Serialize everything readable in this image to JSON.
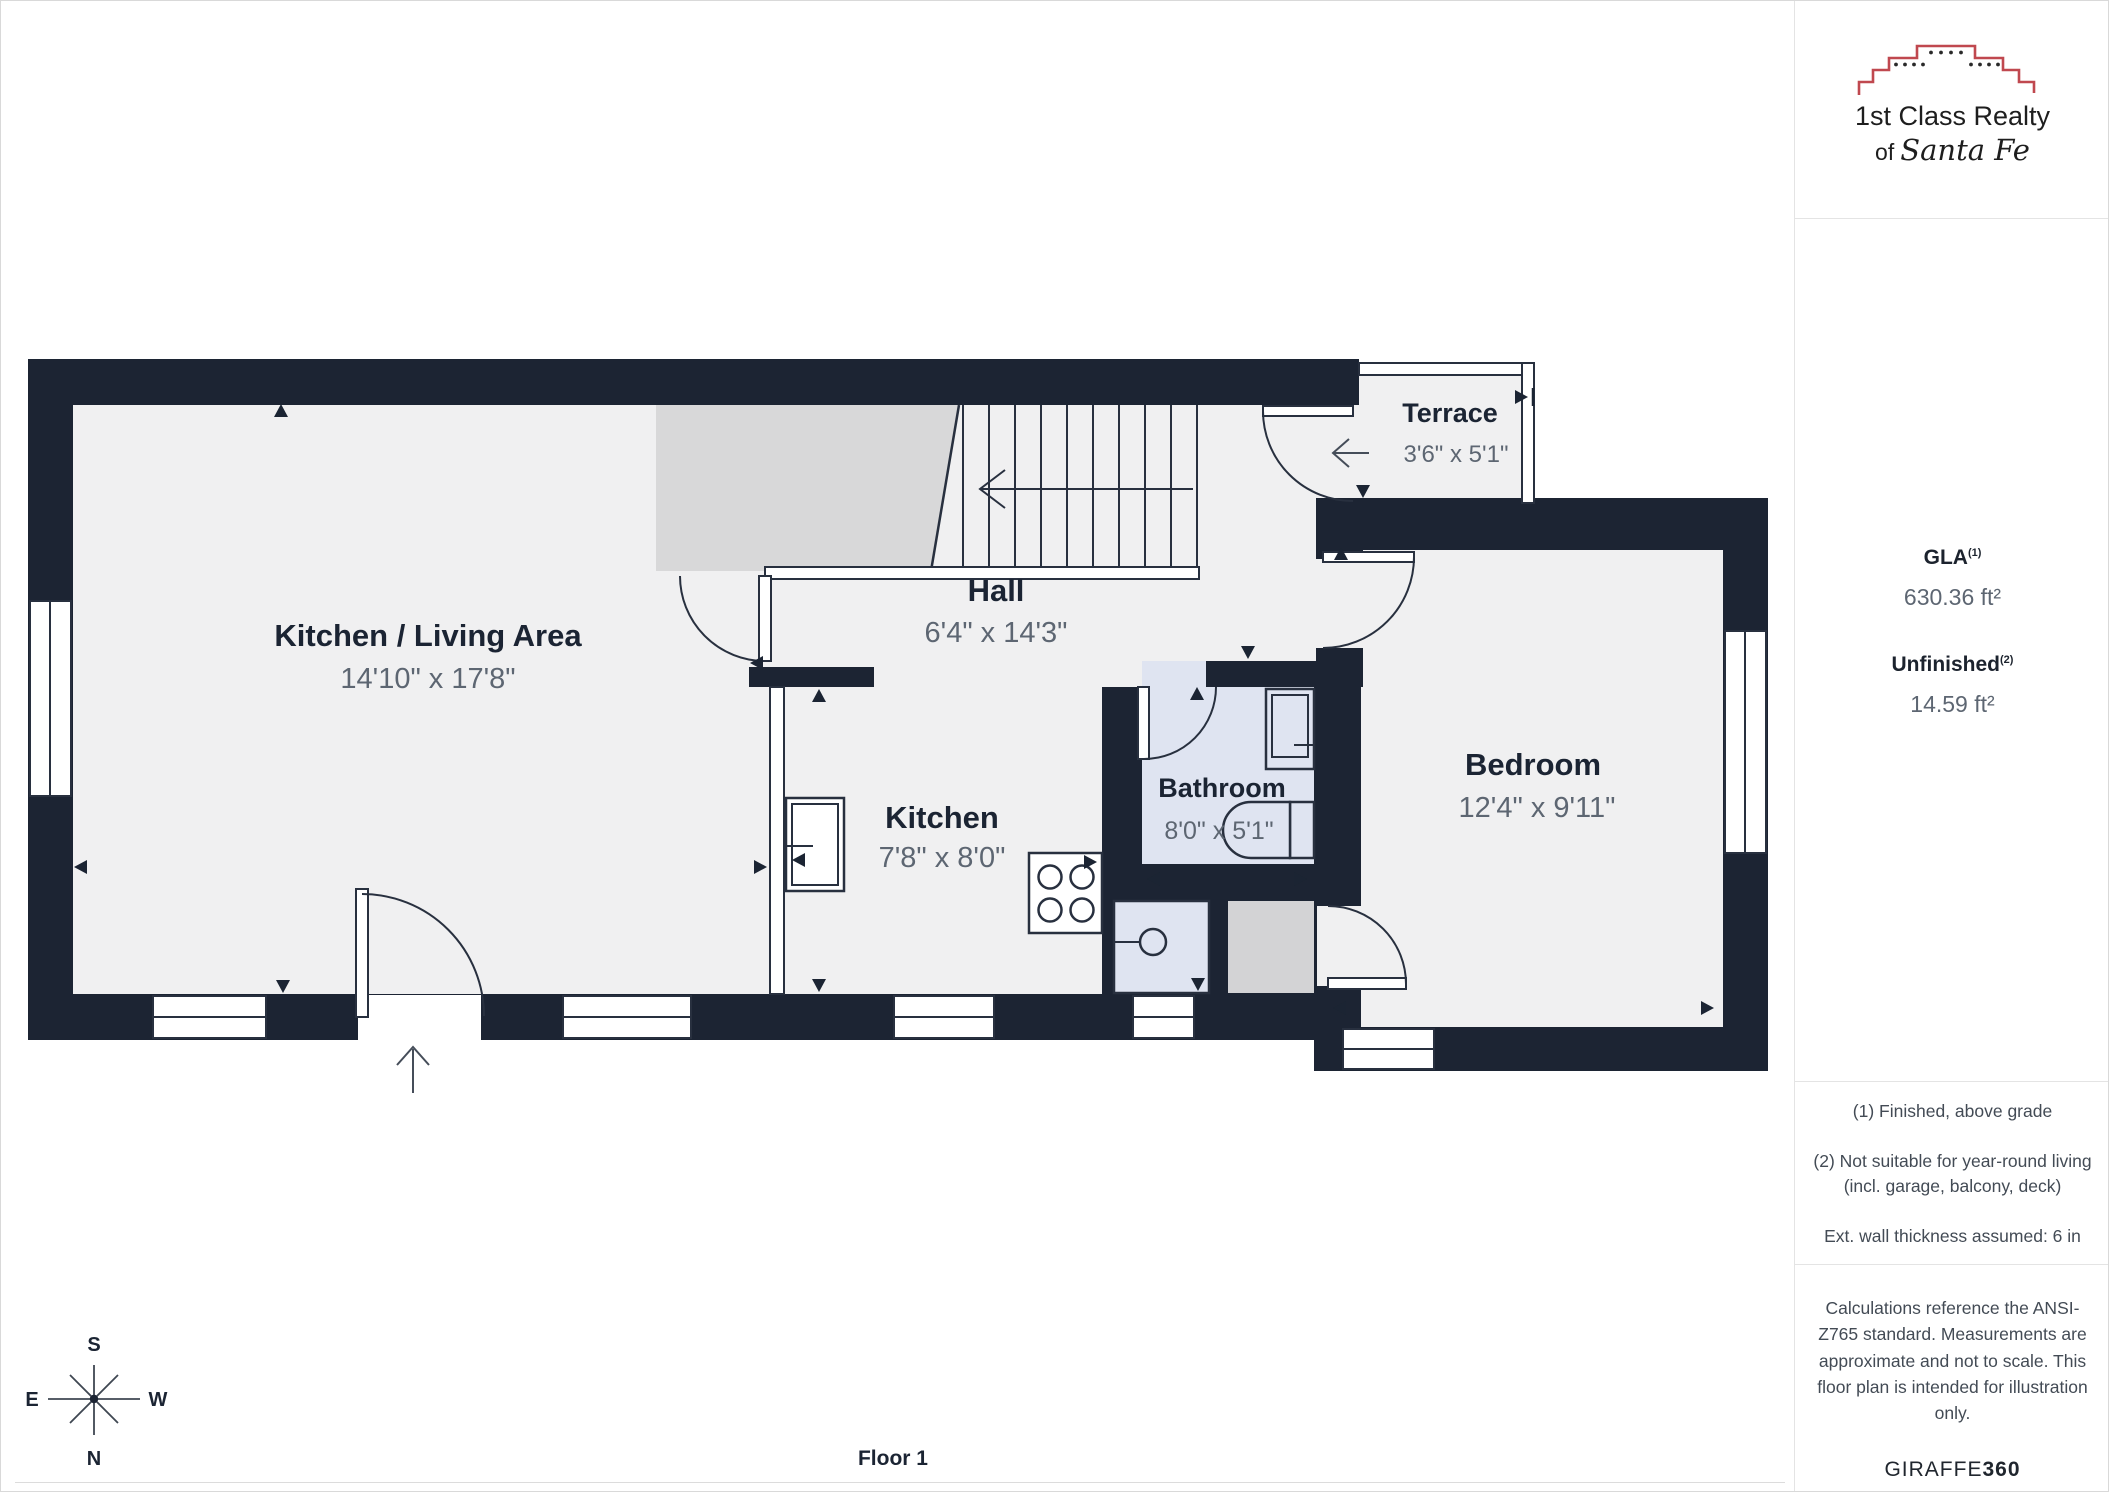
{
  "floor_plan": {
    "floor_label": "Floor 1",
    "rooms": [
      {
        "id": "kitchen-living",
        "name": "Kitchen / Living Area",
        "dims": "14'10\" x 17'8\""
      },
      {
        "id": "hall",
        "name": "Hall",
        "dims": "6'4\" x 14'3\""
      },
      {
        "id": "kitchen",
        "name": "Kitchen",
        "dims": "7'8\" x 8'0\""
      },
      {
        "id": "bathroom",
        "name": "Bathroom",
        "dims": "8'0\" x 5'1\""
      },
      {
        "id": "bedroom",
        "name": "Bedroom",
        "dims": "12'4\" x 9'11\""
      },
      {
        "id": "terrace",
        "name": "Terrace",
        "dims": "3'6\" x 5'1\""
      }
    ],
    "compass": {
      "n": "N",
      "s": "S",
      "e": "E",
      "w": "W"
    }
  },
  "sidebar": {
    "logo": {
      "line1": "1st Class Realty",
      "of": "of",
      "script": "Santa Fe"
    },
    "metrics": [
      {
        "label": "GLA",
        "sup": "(1)",
        "value": "630.36 ft²"
      },
      {
        "label": "Unfinished",
        "sup": "(2)",
        "value": "14.59 ft²"
      }
    ],
    "notes": [
      "(1) Finished, above grade",
      "(2) Not suitable for year-round living (incl. garage, balcony, deck)",
      "Ext. wall thickness assumed: 6 in"
    ],
    "disclaimer": "Calculations reference the ANSI-Z765 standard. Measurements are approximate and not to scale. This floor plan is intended for illustration only.",
    "brand": "GIRAFFE",
    "brand_suffix": "360"
  },
  "colors": {
    "wall": "#1c2433",
    "floor": "#f0f0f1",
    "bathroom_floor": "#dfe4f1",
    "stairs_gray": "#d8d8d9",
    "appliance_gray": "#d3d3d5",
    "logo_red": "#c0484f",
    "room_name_text": "#1b2433",
    "dims_text": "#5d6672"
  }
}
